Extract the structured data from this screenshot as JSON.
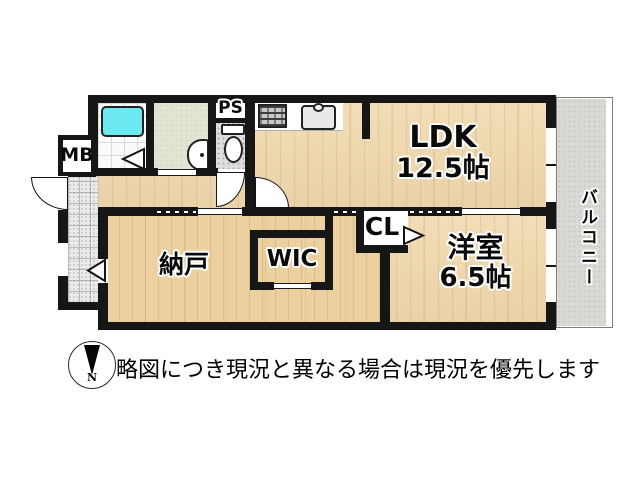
{
  "plan": {
    "ldk": {
      "name": "LDK",
      "size": "12.5帖"
    },
    "western_room": {
      "name": "洋室",
      "size": "6.5帖"
    },
    "storage_room": {
      "name": "納戸"
    },
    "walk_in_closet": {
      "name": "WIC"
    },
    "closet": {
      "name": "CL"
    },
    "pipe_space": {
      "name": "PS"
    },
    "meter_box": {
      "name": "MB"
    },
    "balcony": {
      "name": "バルコニー"
    }
  },
  "footer": {
    "compass_north": "N",
    "disclaimer": "略図につき現況と異なる場合は現況を優先します"
  },
  "colors": {
    "wall": "#161616",
    "flooring_light": "#f1d9ae",
    "flooring_dark": "#ecd0a0",
    "bathtub": "#6ce9f1",
    "washroom_floor": "#e1e5d4",
    "toilet_floor": "#dedede",
    "entrance_tile": "#eaeaea",
    "balcony_floor": "#dadad5"
  }
}
